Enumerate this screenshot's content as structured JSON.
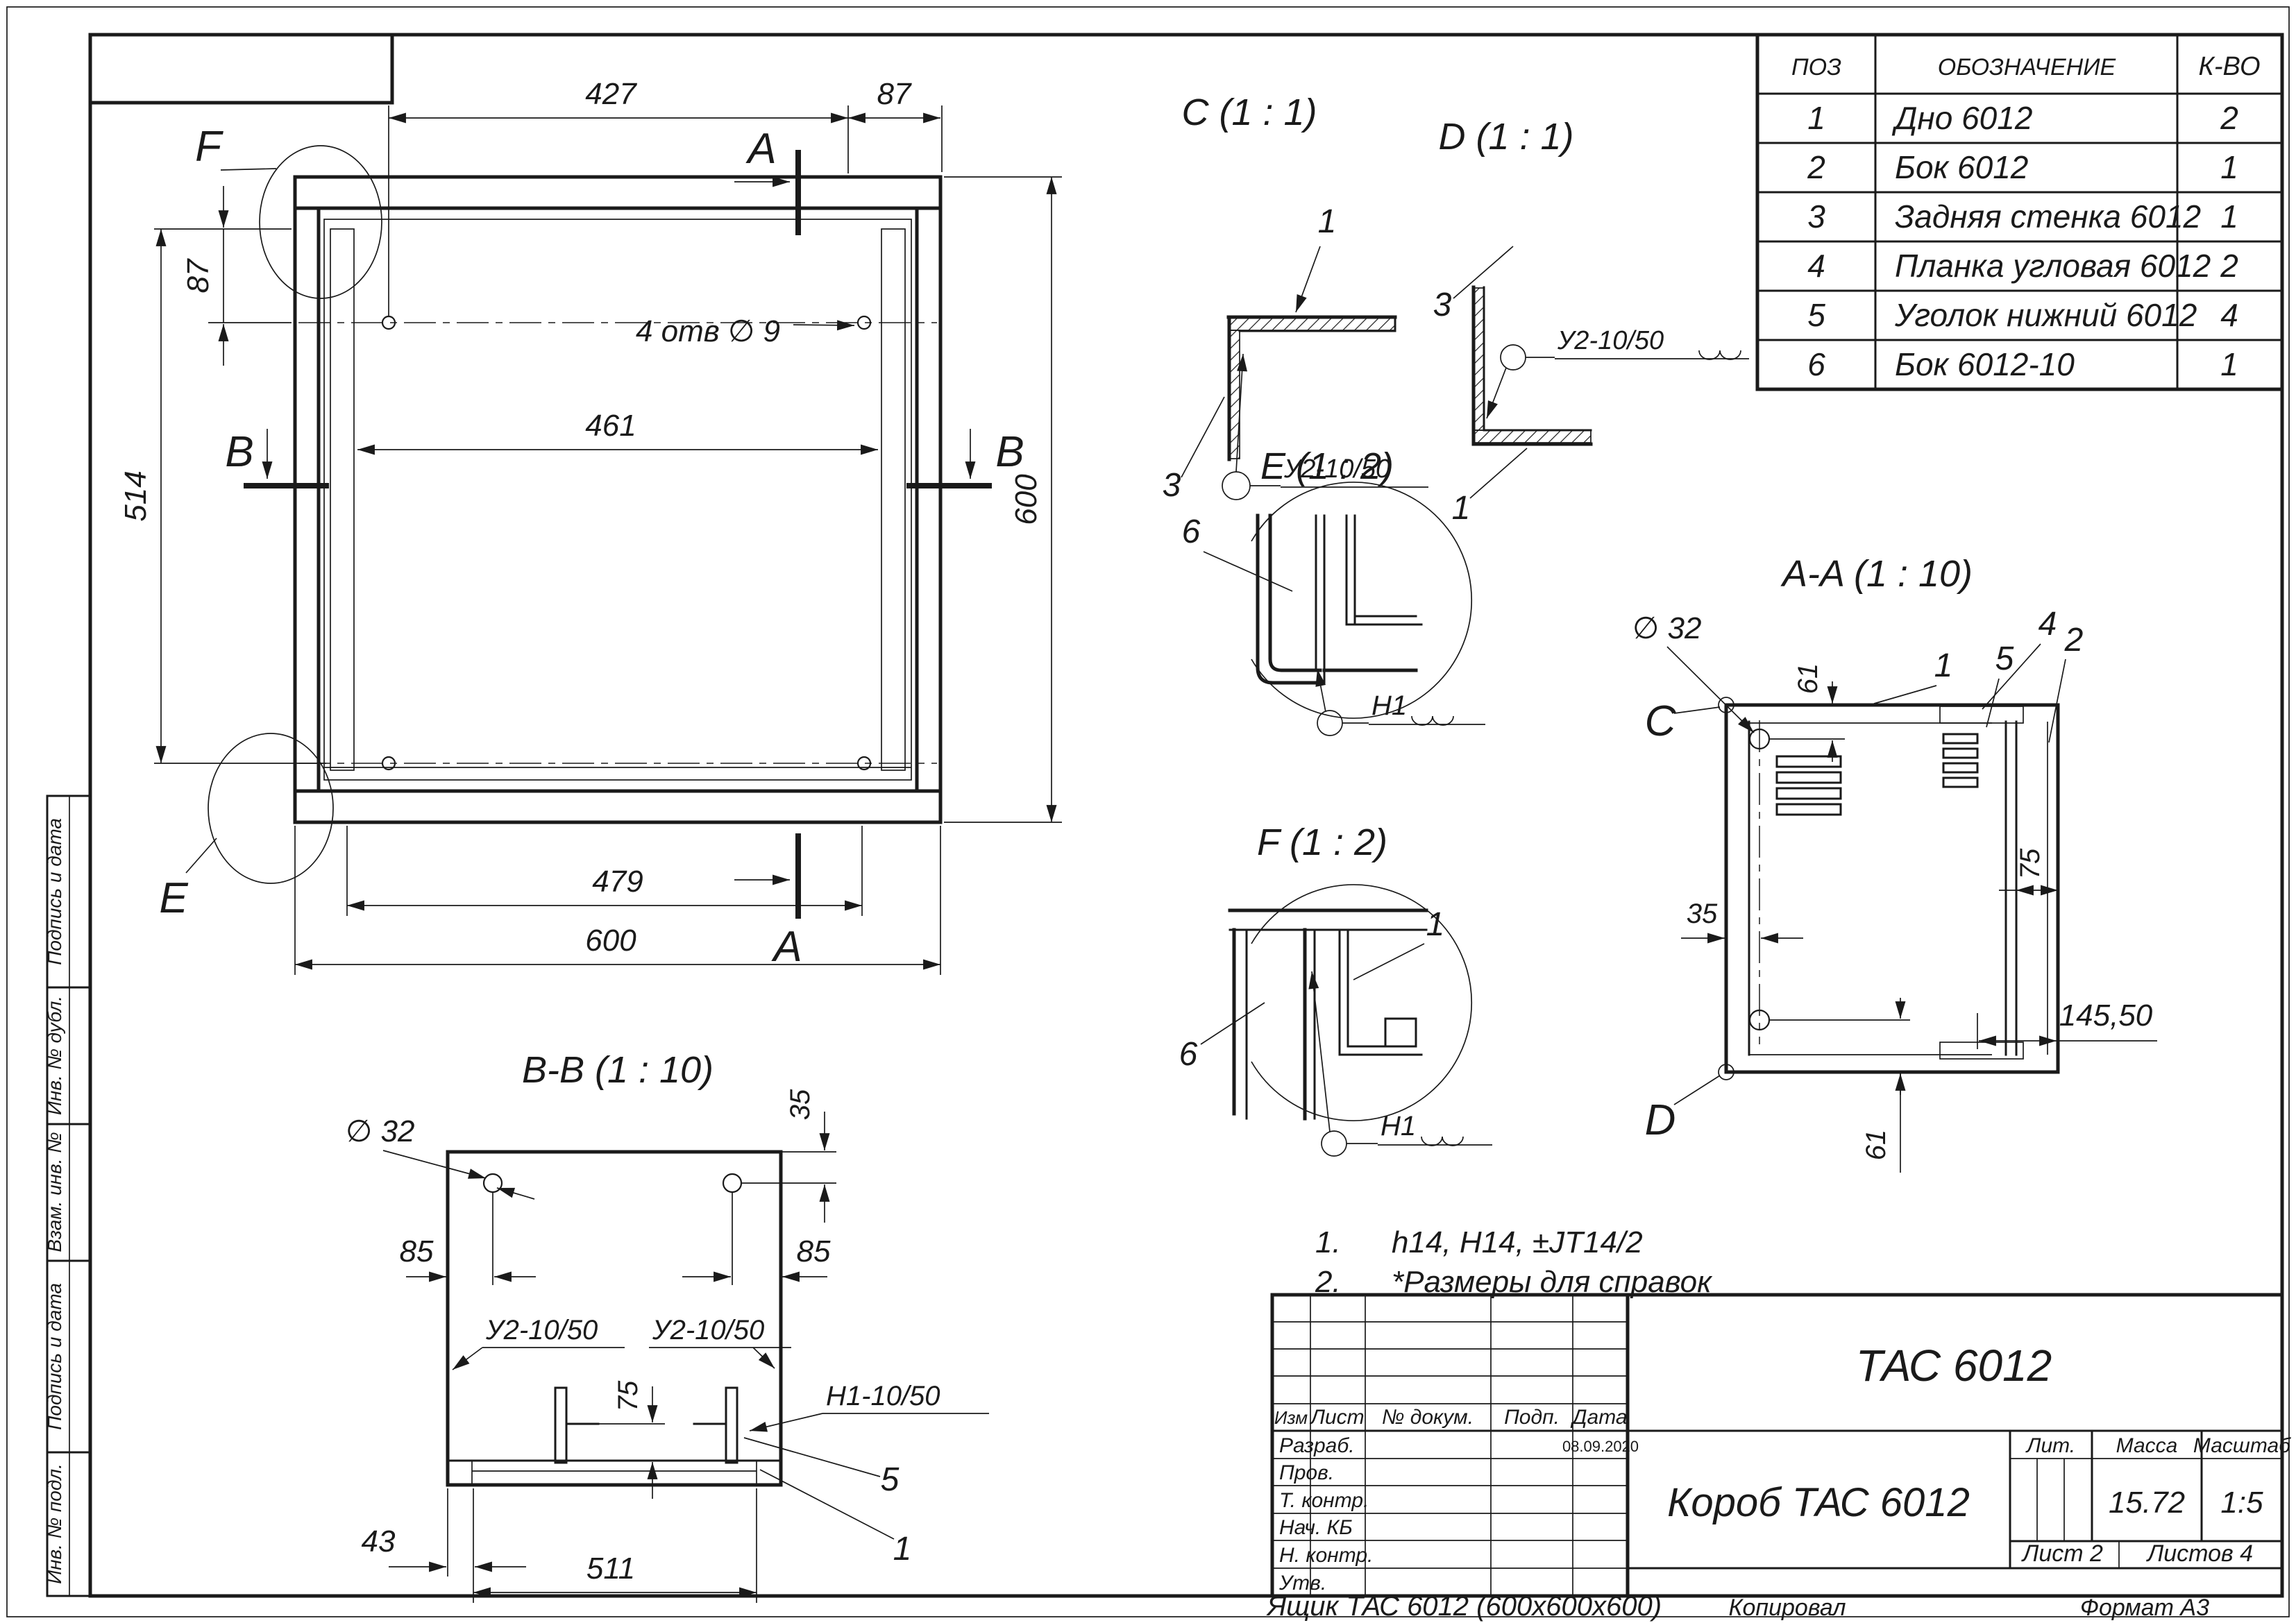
{
  "main_view": {
    "dim_top_427": "427",
    "dim_top_87": "87",
    "dim_left_87": "87",
    "dim_left_514": "514",
    "dim_461": "461",
    "dim_right_600": "600",
    "dim_479": "479",
    "dim_bottom_600": "600",
    "holes_label": "4 отв ∅ 9",
    "section_a_top": "A",
    "section_a_bottom": "A",
    "section_b_left": "B",
    "section_b_right": "B",
    "detail_f_label": "F",
    "detail_e_label": "E"
  },
  "detail_c": {
    "title": "C (1 : 1)",
    "pos1": "1",
    "pos3": "3",
    "weld": "У2-10/50"
  },
  "detail_d": {
    "title": "D (1 : 1)",
    "pos1": "1",
    "pos3": "3",
    "weld": "У2-10/50"
  },
  "detail_e": {
    "title": "E (1 : 2)",
    "pos6": "6",
    "weld": "Н1"
  },
  "detail_f": {
    "title": "F (1 : 2)",
    "pos1": "1",
    "pos6": "6",
    "weld": "Н1"
  },
  "section_aa": {
    "title": "A-A (1 : 10)",
    "dia32": "∅ 32",
    "dim61_top": "61",
    "dim61_bottom": "61",
    "dim35": "35",
    "dim75": "75",
    "dim145": "145,50",
    "pos1": "1",
    "pos2": "2",
    "pos4": "4",
    "pos5": "5",
    "view_c": "C",
    "view_d": "D"
  },
  "section_bb": {
    "title": "B-B (1 : 10)",
    "dia32": "∅ 32",
    "dim35": "35",
    "dim85_left": "85",
    "dim85_right": "85",
    "dim75": "75",
    "dim43": "43",
    "dim511": "511",
    "weld_left": "У2-10/50",
    "weld_right": "У2-10/50",
    "weld_bottom": "Н1-10/50",
    "pos5": "5",
    "pos1": "1"
  },
  "notes": {
    "n1_num": "1.",
    "n1_text": "h14, H14, ±JT14/2",
    "n2_num": "2.",
    "n2_text": "*Размеры для справок"
  },
  "parts_table": {
    "headers": {
      "pos": "ПОЗ",
      "name": "ОБОЗНАЧЕНИЕ",
      "qty": "К-ВО"
    },
    "rows": [
      {
        "pos": "1",
        "name": "Дно 6012",
        "qty": "2"
      },
      {
        "pos": "2",
        "name": "Бок 6012",
        "qty": "1"
      },
      {
        "pos": "3",
        "name": "Задняя стенка 6012",
        "qty": "1"
      },
      {
        "pos": "4",
        "name": "Планка угловая 6012",
        "qty": "2"
      },
      {
        "pos": "5",
        "name": "Уголок нижний 6012",
        "qty": "4"
      },
      {
        "pos": "6",
        "name": "Бок 6012-10",
        "qty": "1"
      }
    ]
  },
  "title_block": {
    "doc_number": "ТАС 6012",
    "doc_name": "Короб ТАС 6012",
    "lit_label": "Лит.",
    "mass_label": "Масса",
    "scale_label": "Масштаб",
    "mass_value": "15.72",
    "scale_value": "1:5",
    "sheet_label": "Лист 2",
    "sheets_label": "Листов 4",
    "col_izm": "Изм",
    "col_list": "Лист",
    "col_doc": "№ докум.",
    "col_podp": "Подп.",
    "col_data": "Дата",
    "row_razrab": "Разраб.",
    "row_prov": "Пров.",
    "row_tkontr": "Т. контр.",
    "row_nachkb": "Нач. КБ",
    "row_nkontr": "Н. контр.",
    "row_utv": "Утв.",
    "date_value": "08.09.2020"
  },
  "sidebar": {
    "cells": [
      "Подпись и дата",
      "Инв. № дубл.",
      "Взам. инв. №",
      "Подпись и дата",
      "Инв. № подл."
    ]
  },
  "footer": {
    "drawing_name": "Ящик ТАС 6012 (600х600х600)",
    "copied_by": "Копировал",
    "format": "Формат А3"
  }
}
